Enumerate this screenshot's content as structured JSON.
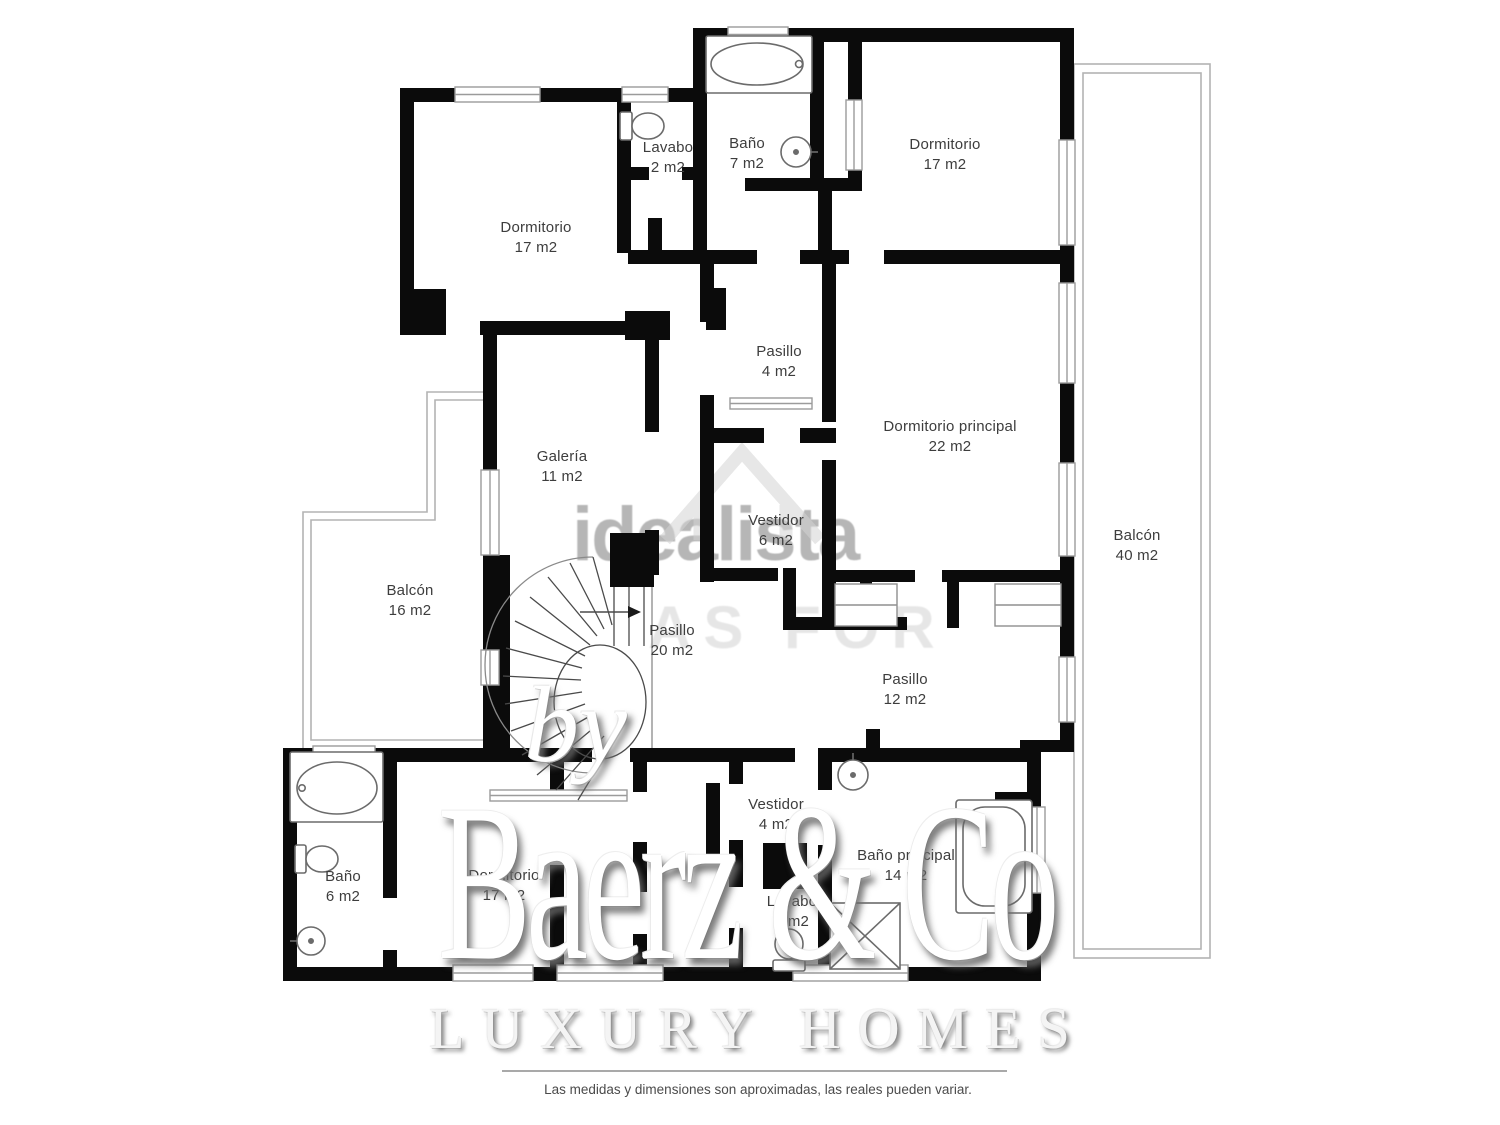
{
  "watermarks": {
    "portal": "idealista",
    "portal_sub": "AS FOR",
    "brand_by": "by",
    "brand_name": "Baerz & Co",
    "brand_tagline": "LUXURY HOMES"
  },
  "disclaimer": "Las medidas y dimensiones son aproximadas, las reales pueden variar.",
  "rooms": [
    {
      "id": "dormitorio-top-left",
      "name": "Dormitorio",
      "area": "17 m2"
    },
    {
      "id": "lavabo-top",
      "name": "Lavabo",
      "area": "2 m2"
    },
    {
      "id": "bano-top",
      "name": "Baño",
      "area": "7 m2"
    },
    {
      "id": "dormitorio-top-right",
      "name": "Dormitorio",
      "area": "17 m2"
    },
    {
      "id": "pasillo-4",
      "name": "Pasillo",
      "area": "4 m2"
    },
    {
      "id": "dormitorio-principal",
      "name": "Dormitorio principal",
      "area": "22 m2"
    },
    {
      "id": "galeria",
      "name": "Galería",
      "area": "11 m2"
    },
    {
      "id": "vestidor-6",
      "name": "Vestidor",
      "area": "6 m2"
    },
    {
      "id": "balcon-16",
      "name": "Balcón",
      "area": "16 m2"
    },
    {
      "id": "pasillo-20",
      "name": "Pasillo",
      "area": "20 m2"
    },
    {
      "id": "pasillo-12",
      "name": "Pasillo",
      "area": "12 m2"
    },
    {
      "id": "balcon-40",
      "name": "Balcón",
      "area": "40 m2"
    },
    {
      "id": "bano-6",
      "name": "Baño",
      "area": "6 m2"
    },
    {
      "id": "dormitorio-bottom",
      "name": "Dormitorio",
      "area": "17 m2"
    },
    {
      "id": "vestidor-4",
      "name": "Vestidor",
      "area": "4 m2"
    },
    {
      "id": "lavabo-bottom",
      "name": "Lavabo",
      "area": "2 m2"
    },
    {
      "id": "bano-principal",
      "name": "Baño principal",
      "area": "14 m2"
    }
  ],
  "colors": {
    "wall": "#0b0b0b",
    "fixture": "#666666",
    "railing": "#b3b3b3",
    "label_text": "#3d3d3d",
    "watermark_gray": "#b6b6b6",
    "disclaimer_text": "#4b4b4b"
  }
}
